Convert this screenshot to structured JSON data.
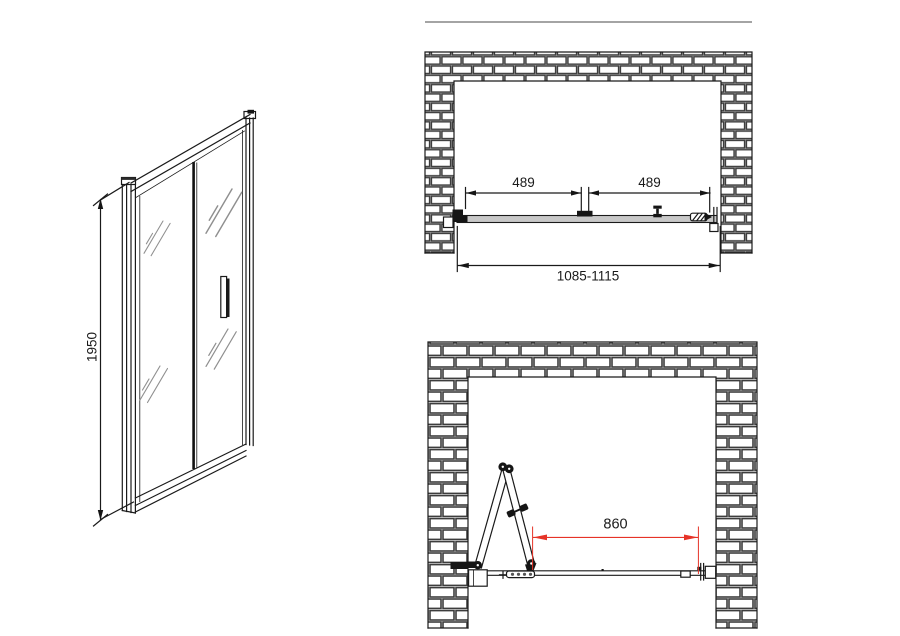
{
  "colors": {
    "line": "#1a1a1a",
    "dimension_red": "#e63327",
    "track_fill": "#c8c8c8",
    "glass_shine": "#8f8f8f",
    "brick_joint": "#3d3d3d"
  },
  "front_elevation": {
    "height": "1950"
  },
  "plan_closed": {
    "left_panel_width": "489",
    "right_panel_width": "489",
    "opening_width_range": "1085-1115"
  },
  "plan_open": {
    "entry_width": "860"
  }
}
